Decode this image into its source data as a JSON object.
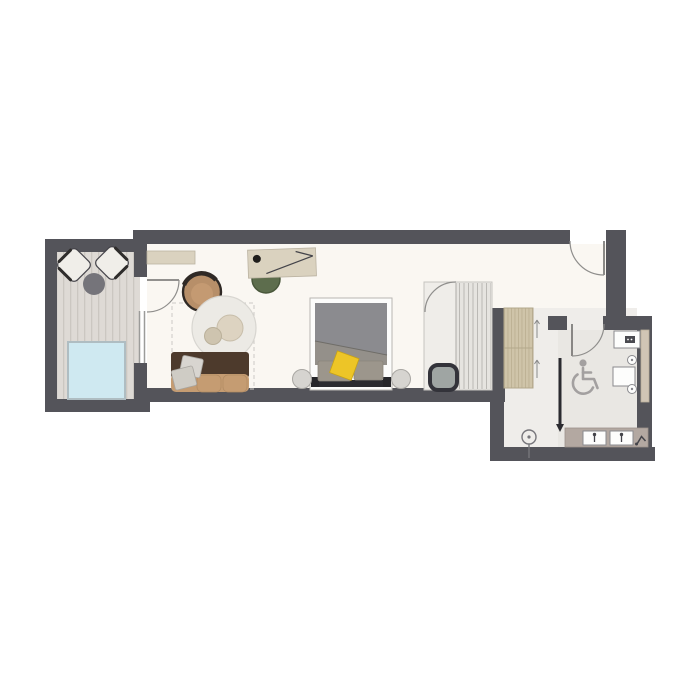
{
  "title": "hotel-suite-floor-plan",
  "colors": {
    "wall": "#54545A",
    "floor-main": "#FAF7F2",
    "floor-east": "#EFEDEA",
    "floor-bath": "#E9E7E3",
    "deck": "#DEDAD5",
    "deck-stripe": "#CBC7C1",
    "pool": "#CFE9F1",
    "pool-border": "#AFBDC2",
    "wood": "#DAD2BF",
    "shelf": "#CFC4A9",
    "shelf-stripe": "#BCB093",
    "closet": "#E6E4E0",
    "closet-stripe": "#BBB9B5",
    "sofa-back": "#4D3A2C",
    "sofa-seat": "#C59C72",
    "armchair": "#B78F69",
    "chair-green": "#5D6D4D",
    "duvet": "#8B8B8F",
    "duvet-fold": "#94908A",
    "pillow-yellow": "#EDC527",
    "stool": "#9FA5A3",
    "stool-border": "#33333A",
    "vanity": "#B3A8A1",
    "fixture-white": "#FDFDFC",
    "access-gray": "#A3A0A0",
    "nightstand": "#D6D4D0",
    "rug": "#ECEAE5",
    "line": "#8F8E8C",
    "dark": "#2B2B30"
  },
  "icons": {
    "accessibility": "wheelchair-icon",
    "faucet": "tap-icon",
    "hairdryer": "hairdryer-icon",
    "lamp": "floor-lamp-icon",
    "slide_direction": "arrow-down-icon",
    "drawer_direction": "arrow-up-icon"
  }
}
